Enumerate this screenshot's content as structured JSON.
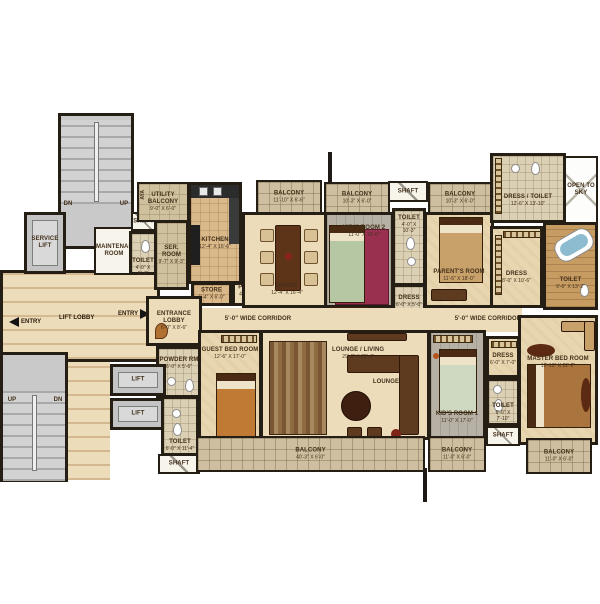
{
  "labels": {
    "dn": "DN",
    "up": "UP",
    "entry": "ENTRY",
    "lift": "LIFT",
    "lift_lobby": "LIFT LOBBY",
    "shaft": "SHAFT",
    "aya": "AYA",
    "fhc": "F.H.C",
    "open_to_sky": "OPEN TO SKY",
    "lounge": "LOUNGE",
    "corridor": "5'-0\" WIDE CORRIDOR",
    "service_lift": "SERVICE LIFT",
    "maintenance_room": "MAINTENANCE ROOM"
  },
  "rooms": {
    "utility_balcony": {
      "name": "UTILITY BALCONY",
      "dims": "9'-0\" X 6'-0\""
    },
    "ser_room": {
      "name": "SER. ROOM",
      "dims": "9'-7\" X 9'-3\""
    },
    "toilet_service": {
      "name": "TOILET",
      "dims": "4'-0\" X 5'-4\""
    },
    "kitchen": {
      "name": "KITCHEN",
      "dims": "12'-4\" X 16'-6\""
    },
    "store": {
      "name": "STORE",
      "dims": "6'-4\" X 6'-0\""
    },
    "puja": {
      "name": "PUJA",
      "dims": "4'-0\" X 3'-7\""
    },
    "balcony_dining": {
      "name": "BALCONY",
      "dims": "11'-10\" X 6'-6\""
    },
    "dining": {
      "name": "DINING",
      "dims": "12'-4\" X 16'-4\""
    },
    "balcony_kids2": {
      "name": "BALCONY",
      "dims": "10'-3\" X 6'-0\""
    },
    "balcony_parents": {
      "name": "BALCONY",
      "dims": "10'-3\" X 6'-0\""
    },
    "kids_room2": {
      "name": "KID'S ROOM 2",
      "dims": "11'-0\" X 15'-0\""
    },
    "toilet_kids2": {
      "name": "TOILET",
      "dims": "4'-0\" X 10'-3\""
    },
    "dress_kids2": {
      "name": "DRESS",
      "dims": "6'-0\" X 5'-0\""
    },
    "parents_room": {
      "name": "PARENT'S ROOM",
      "dims": "11'-6\" X 18'-0\""
    },
    "dress_toilet": {
      "name": "DRESS / TOILET",
      "dims": "12'-6\" X 13'-10\""
    },
    "dress_master": {
      "name": "DRESS",
      "dims": "8'-0\" X 10'-6\""
    },
    "toilet_master": {
      "name": "TOILET",
      "dims": "9'-6\" X 13'-2\""
    },
    "entrance_lobby": {
      "name": "ENTRANCE LOBBY",
      "dims": "6'-0\" X 8'-6\""
    },
    "powder_rm": {
      "name": "POWDER RM",
      "dims": "6'-0\" X 5'-6\""
    },
    "guest_bed": {
      "name": "GUEST BED ROOM",
      "dims": "12'-6\" X 17'-0\""
    },
    "lounge_living": {
      "name": "LOUNGE / LIVING",
      "dims": "29'-6\" X 22'-4\""
    },
    "kids_room1": {
      "name": "KID'S ROOM 1",
      "dims": "11'-0\" X 17'-0\""
    },
    "dress_kids1": {
      "name": "DRESS",
      "dims": "6'-0\" X 7'-0\""
    },
    "toilet_kids1": {
      "name": "TOILET",
      "dims": "6'-0\" X 7'-10\""
    },
    "master_bed": {
      "name": "MASTER BED ROOM",
      "dims": "12'-10\" X 22'-2\""
    },
    "toilet_lobby": {
      "name": "TOILET",
      "dims": "6'-0\" X 11'-4\""
    },
    "balcony_bottom": {
      "name": "BALCONY",
      "dims": "40'-3\" X 6'-0\""
    },
    "balcony_kids1": {
      "name": "BALCONY",
      "dims": "11'-0\" X 6'-0\""
    },
    "balcony_master": {
      "name": "BALCONY",
      "dims": "11'-0\" X 6'-0\""
    }
  },
  "colors": {
    "wall": "#241e15",
    "marble_floor": "#ecdcba",
    "balcony_tile": "#cdbf9f",
    "label_text": "#42301a",
    "rug_pink": "#9a3050",
    "furniture_brown": "#5e3a1e"
  }
}
